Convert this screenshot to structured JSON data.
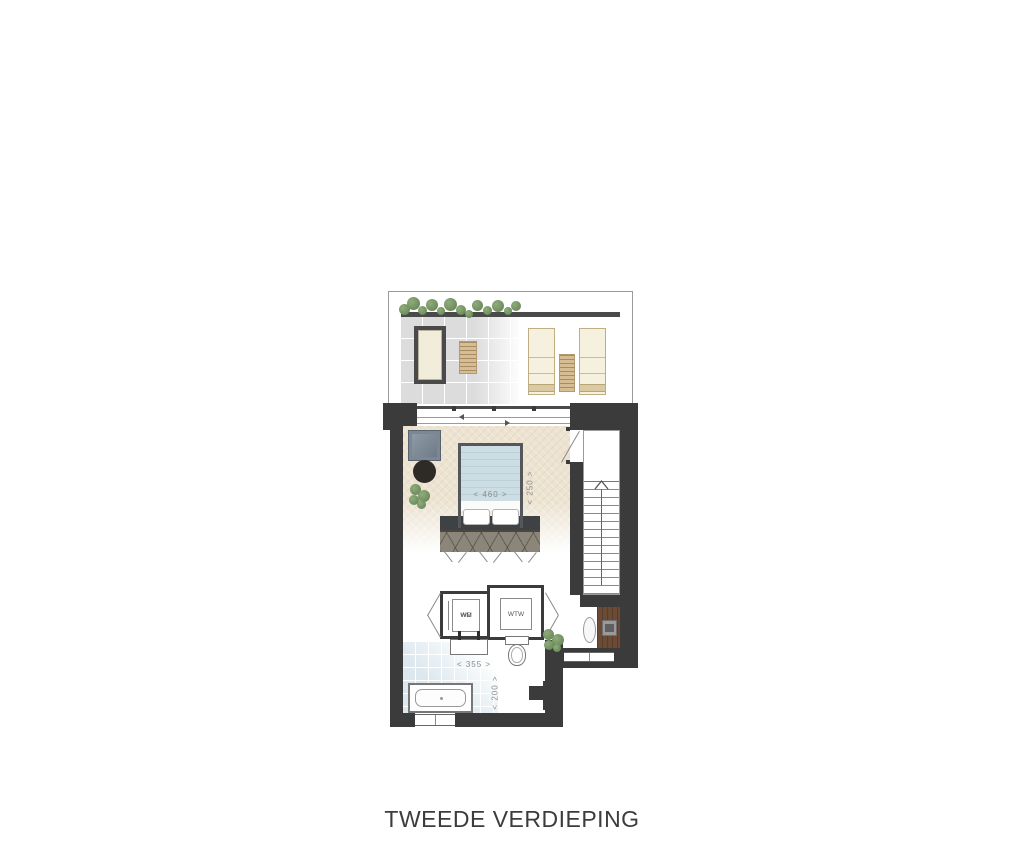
{
  "title": "TWEEDE VERDIEPING",
  "labels": {
    "bed_width": "< 460 >",
    "bed_depth": "< 250 >",
    "bath_width": "< 355 >",
    "bath_depth": "< 200 >",
    "washer": "WM",
    "dryer": "WD",
    "heat_recovery": "WTW"
  },
  "colors": {
    "wall": "#3b3b3b",
    "bedroom_floor": "#ece3d1",
    "bathroom_tile": "#dce8ee",
    "terrace_tile": "#dcdcdc",
    "bed_blanket": "#cddde4",
    "wardrobe": "#8b8679",
    "desk_wood": "#6b4a36",
    "plant_green": "#5f7f4f",
    "dimension_text": "#8a8a8a",
    "title_text": "#3c3c3c"
  }
}
